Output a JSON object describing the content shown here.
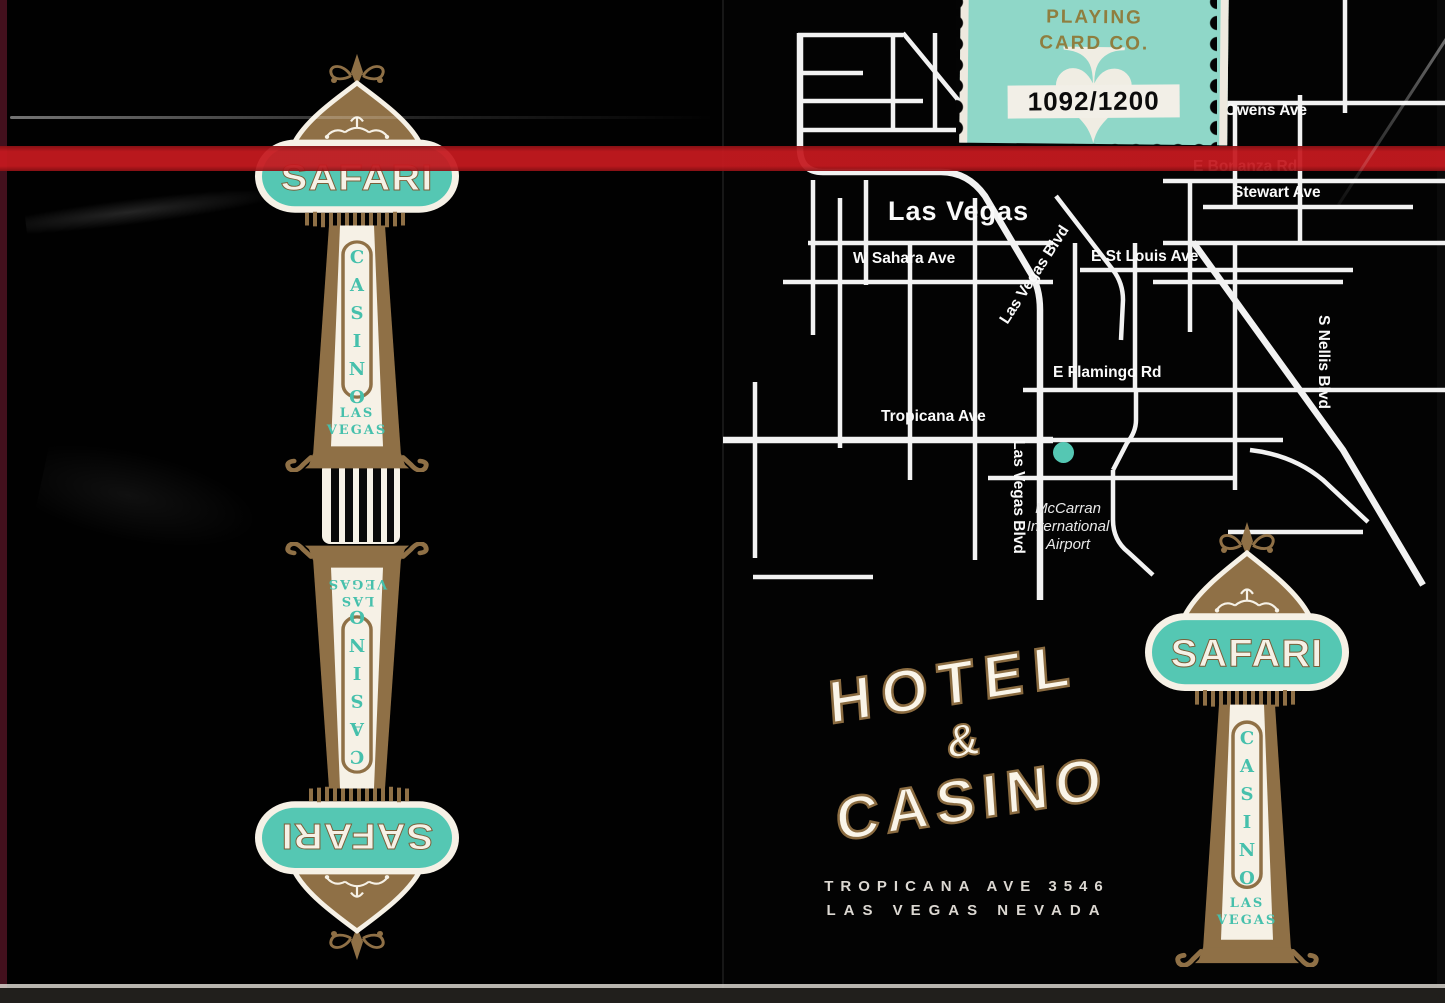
{
  "stripe_color": "#c5191f",
  "sign": {
    "name": "SAFARI",
    "venue": "CASINO",
    "city_line1": "LAS",
    "city_line2": "VEGAS",
    "teal": "#55c7b3",
    "brown": "#8f7046"
  },
  "seal": {
    "brand_line1": "GEMINI",
    "brand_line2": "PLAYING",
    "brand_line3": "CARD CO.",
    "number": "1092/1200",
    "spade_glyph": "♠",
    "teal": "#8fd7c8",
    "gold": "#8f7e3f"
  },
  "map": {
    "city": "Las Vegas",
    "owens": "E Owens Ave",
    "bonanza": "E Bonanza Rd",
    "stewart": "Stewart Ave",
    "sahara": "W Sahara Ave",
    "stlouis": "E St Louis Ave",
    "lv_blvd_upper": "Las Vegas Blvd",
    "nellis": "S Nellis Blvd",
    "flamingo": "E Flamingo Rd",
    "tropicana": "Tropicana Ave",
    "lv_blvd_lower": "Las Vegas Blvd",
    "airport_line1": "McCarran",
    "airport_line2": "International",
    "airport_line3": "Airport",
    "marker_color": "#55c7b3"
  },
  "title": {
    "line1": "HOTEL",
    "amp": "&",
    "line2": "CASINO"
  },
  "address": {
    "line1": "TROPICANA AVE 3546",
    "line2": "LAS VEGAS NEVADA"
  }
}
